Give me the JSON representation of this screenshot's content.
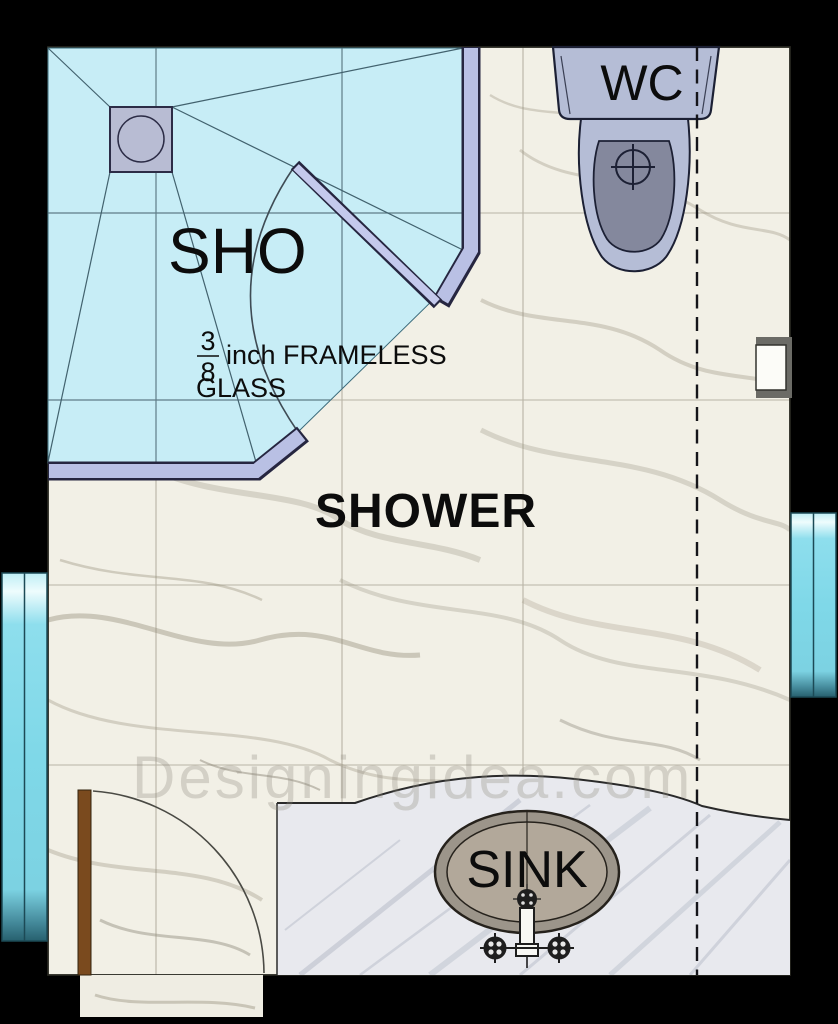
{
  "plan": {
    "title": "bathroom-floor-plan",
    "labels": {
      "shower_pan": "SHO",
      "room": "SHOWER",
      "wc": "WC",
      "sink": "SINK",
      "glass_frac_num": "3",
      "glass_frac_den": "8",
      "glass_note_line1": "inch FRAMELESS",
      "glass_note_line2": "GLASS"
    },
    "watermark": "Designingidea.com",
    "colors": {
      "wall": "#000000",
      "floor": "#f2f0e6",
      "shower_floor": "#c7edf6",
      "glass": "#b9c0e4",
      "door_glass": "#c4c9ec",
      "drain": "#b8bcd3",
      "fixture": "#b5bdd6",
      "fixture_inner": "#84889d",
      "counter": "#e8e9ee",
      "sink_rim": "#9c958a",
      "sink_basin": "#b2a89a",
      "entry_door": "#7a4a1e",
      "window_glass": "#7fd8e8",
      "outline": "#1c2034"
    }
  }
}
